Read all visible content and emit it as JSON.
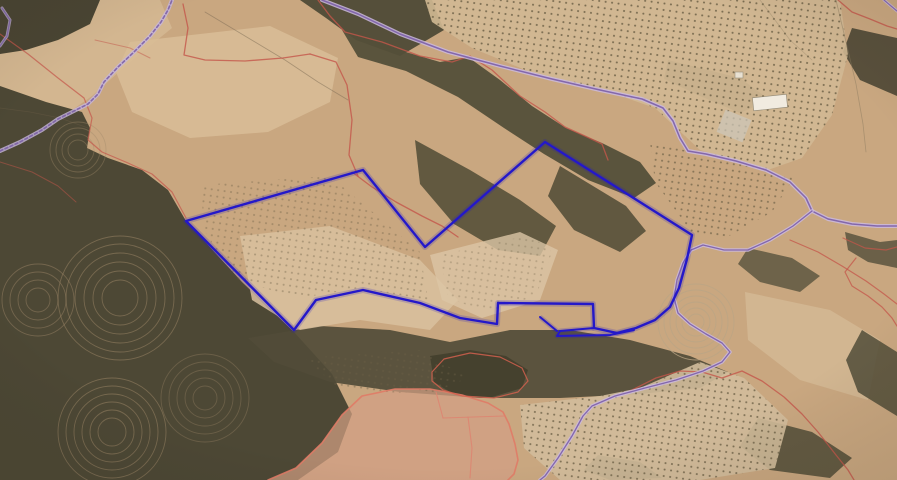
{
  "map": {
    "canvas": {
      "width": 897,
      "height": 480
    },
    "colors": {
      "selection_blue": "#2418c9",
      "road_purple": "#7e62aa",
      "road_casing": "#cbbade",
      "cadastral_red": "#c4564a",
      "parcel_pink_outline": "#e07b66",
      "terrain_base": "#c9a780",
      "scrub_dark": "#4d4835",
      "grove_dot": "#6b5f45"
    },
    "terrain": [
      {
        "name": "base-ground",
        "points": "0,0 897,0 897,480 0,480",
        "fill": "#c9a780",
        "opacity": 1
      },
      {
        "name": "snake-field",
        "points": "40,0 160,0 172,28 130,62 92,96 58,120 26,142 0,152 0,50 28,44",
        "fill": "#d4b690",
        "opacity": 0.95
      },
      {
        "name": "pale-top-center-field",
        "points": "130,42 270,26 338,58 330,102 268,132 190,138 132,112 116,72",
        "fill": "#d8bc96",
        "opacity": 0.9
      },
      {
        "name": "top-left-scrub",
        "points": "0,0 100,0 90,24 58,40 26,50 0,54",
        "fill": "#4a4533",
        "opacity": 1
      },
      {
        "name": "top-bridge-scrub",
        "points": "300,0 432,0 444,30 400,56 356,40 326,18",
        "fill": "#4f4a36",
        "opacity": 0.95
      },
      {
        "name": "left-forest",
        "points": "0,86 46,102 82,112 90,128 87,148 108,158 142,170 168,190 186,221 242,282 294,332 332,374 352,414 338,452 298,480 0,480",
        "fill": "#4d4835",
        "opacity": 1
      },
      {
        "name": "central-scrub-1",
        "points": "342,30 392,48 440,62 468,57 500,80 532,106 566,128 602,143 640,162 656,183 634,198 588,180 544,154 504,128 458,97 406,71 358,57",
        "fill": "#544f39",
        "opacity": 0.95
      },
      {
        "name": "central-scrub-2",
        "points": "415,140 470,170 520,200 556,226 540,256 498,250 454,224 420,184",
        "fill": "#565138",
        "opacity": 0.9
      },
      {
        "name": "central-scrub-3",
        "points": "560,166 626,206 646,231 620,252 574,230 548,196",
        "fill": "#4f4a35",
        "opacity": 0.85
      },
      {
        "name": "right-corner-forest",
        "points": "852,28 897,38 897,96 860,80 843,52",
        "fill": "#4c4734",
        "opacity": 0.9
      },
      {
        "name": "right-scrub-a",
        "points": "668,60 740,78 770,100 740,113 700,96 664,79",
        "fill": "#56513b",
        "opacity": 0.7
      },
      {
        "name": "mid-scrub-band",
        "points": "248,338 320,326 390,330 450,342 510,330 570,330 630,340 690,356 728,372 700,388 640,394 560,398 480,398 400,392 330,382 274,362",
        "fill": "#514c38",
        "opacity": 0.92
      },
      {
        "name": "dark-tree-cluster",
        "points": "430,356 470,350 506,356 528,370 522,388 492,397 455,395 434,382",
        "fill": "#45412e",
        "opacity": 1
      },
      {
        "name": "right-blob-b",
        "points": "748,248 792,258 820,276 800,292 760,282 738,264",
        "fill": "#57523c",
        "opacity": 0.8
      },
      {
        "name": "right-blob-c",
        "points": "845,232 880,242 897,240 897,268 868,262 848,250",
        "fill": "#544f3a",
        "opacity": 0.8
      },
      {
        "name": "pale-center-field",
        "points": "240,236 330,226 420,260 458,300 430,330 360,320 300,330 252,300",
        "fill": "#d9c19f",
        "opacity": 0.85
      },
      {
        "name": "pale-center-field-2",
        "points": "430,255 520,232 558,250 540,300 482,318 442,300",
        "fill": "#dcc5a5",
        "opacity": 0.8
      },
      {
        "name": "pale-right-slope",
        "points": "745,292 830,310 880,340 868,400 800,380 748,340",
        "fill": "#d6bc98",
        "opacity": 0.7
      },
      {
        "name": "right-blob-d",
        "points": "862,330 897,352 897,416 858,392 846,360",
        "fill": "#524d38",
        "opacity": 0.85
      },
      {
        "name": "right-blob-e",
        "points": "758,418 812,432 852,458 830,478 770,470 740,446",
        "fill": "#514c37",
        "opacity": 0.85
      },
      {
        "name": "small-scrub-br",
        "points": "598,455 640,462 662,478 610,480 584,470",
        "fill": "#524d38",
        "opacity": 0.8
      },
      {
        "name": "pink-parcel-fill",
        "points": "268,480 296,468 322,443 342,415 362,396 395,389 430,389 462,395 488,403 503,412 509,424 515,444 518,460 514,474 508,480",
        "fill": "#d2a083",
        "opacity": 0.72
      }
    ],
    "groves": [
      {
        "name": "grove-top-right",
        "points": "425,0 840,0 848,55 832,115 802,158 768,170 700,150 655,108 598,88 540,76 472,48 432,22",
        "base": "#d2b994",
        "dotOpacity": 0.85
      },
      {
        "name": "grove-right-small",
        "points": "650,142 795,176 772,212 722,240 692,233 655,182",
        "dotOpacity": 0.7
      },
      {
        "name": "grove-center-left",
        "points": "200,185 330,176 420,252 428,300 360,288 300,298 235,280 205,232",
        "dotOpacity": 0.4
      },
      {
        "name": "grove-bottom-right",
        "points": "520,405 600,396 640,388 700,362 744,378 788,420 775,468 700,480 560,480 524,448",
        "base": "#d2bc9b",
        "dotOpacity": 0.8
      },
      {
        "name": "grove-bottom-small",
        "points": "305,358 420,350 468,378 430,394 340,390",
        "dotOpacity": 0.45
      },
      {
        "name": "grove-center-sparse",
        "points": "440,255 530,235 552,252 536,296 486,312 448,298",
        "dotOpacity": 0.3
      }
    ],
    "contours": [
      {
        "name": "terrace-left-1",
        "cx": 120,
        "cy": 298,
        "radii": [
          18,
          27,
          36,
          45,
          54,
          62
        ],
        "stroke": "#a18a6a",
        "opacity": 0.5
      },
      {
        "name": "terrace-left-2",
        "cx": 112,
        "cy": 432,
        "radii": [
          14,
          22,
          30,
          38,
          46,
          54
        ],
        "stroke": "#a18a6a",
        "opacity": 0.5
      },
      {
        "name": "terrace-left-3",
        "cx": 38,
        "cy": 300,
        "radii": [
          12,
          20,
          28,
          36
        ],
        "stroke": "#a18a6a",
        "opacity": 0.45
      },
      {
        "name": "terrace-left-4",
        "cx": 205,
        "cy": 398,
        "radii": [
          12,
          20,
          28,
          36,
          44
        ],
        "stroke": "#a18a6a",
        "opacity": 0.35
      },
      {
        "name": "terrace-left-5",
        "cx": 78,
        "cy": 150,
        "radii": [
          10,
          16,
          22,
          28
        ],
        "stroke": "#a18a6a",
        "opacity": 0.4
      },
      {
        "name": "terrace-knoll-right",
        "cx": 696,
        "cy": 322,
        "radii": [
          8,
          14,
          20,
          26,
          32,
          38
        ],
        "stroke": "#baa584",
        "opacity": 0.8
      }
    ],
    "tracks": [
      {
        "name": "track-top-center",
        "points": "205,12 245,36 285,60 318,82 348,100",
        "color": "#7a6a52",
        "width": 0.8,
        "opacity": 0.5
      },
      {
        "name": "track-top-right-1",
        "points": "836,0 846,42 856,84 863,124 866,152",
        "color": "#8a7a5e",
        "width": 0.8,
        "opacity": 0.5
      },
      {
        "name": "track-top-right-2",
        "points": "760,0 790,40 812,60",
        "color": "#8a7a5e",
        "width": 0.8,
        "opacity": 0.35
      },
      {
        "name": "track-forest-edge",
        "points": "0,108 30,112 60,118 88,128",
        "color": "#6f6048",
        "width": 0.8,
        "opacity": 0.4
      }
    ],
    "cadastral": [
      {
        "name": "cadastral-topleft-1",
        "points": "183,4 188,28 184,55 205,60 245,61 283,58 310,54",
        "color": "#c4564a",
        "width": 1.3,
        "opacity": 0.8
      },
      {
        "name": "cadastral-topleft-2",
        "points": "310,54 336,62 347,85 352,120 349,155 358,176",
        "color": "#c4564a",
        "width": 1.3,
        "opacity": 0.8
      },
      {
        "name": "cadastral-central-top",
        "points": "318,0 330,16 345,32 382,42 420,56 452,62 470,56 492,70 520,96 545,112 565,127 585,136 602,144 608,160",
        "color": "#c4564a",
        "width": 1.3,
        "opacity": 0.8
      },
      {
        "name": "cadastral-central-bottom",
        "points": "352,172 372,187 396,202 422,216 442,226 458,237",
        "color": "#c4564a",
        "width": 1.3,
        "opacity": 0.8
      },
      {
        "name": "cadastral-forest-edge",
        "points": "0,34 28,54 58,78 84,98 92,118 88,140 102,152 128,163 152,174 172,192 186,218",
        "color": "#c4564a",
        "width": 1.2,
        "opacity": 0.7
      },
      {
        "name": "pink-parcel-outline",
        "points": "268,480 296,468 322,443 342,415 362,396 395,389 430,389 462,395 488,403 503,412 509,424 515,444 518,460 514,474 508,480",
        "color": "#e07b66",
        "width": 1.6,
        "opacity": 0.9
      },
      {
        "name": "pink-parcel-inner-1",
        "points": "436,392 443,418",
        "color": "#dd8571",
        "width": 1.1,
        "opacity": 0.9
      },
      {
        "name": "pink-parcel-inner-2",
        "points": "443,418 504,416",
        "color": "#dd8571",
        "width": 1.1,
        "opacity": 0.9
      },
      {
        "name": "pink-parcel-inner-3",
        "points": "468,417 472,448 470,478",
        "color": "#dd8571",
        "width": 1.1,
        "opacity": 0.9
      },
      {
        "name": "cadastral-cluster-ring",
        "points": "432,372 444,359 470,353 500,357 522,368 528,381 518,392 494,398 462,396 443,390 432,381",
        "color": "#d2604e",
        "width": 1.2,
        "opacity": 0.85,
        "closed": true
      },
      {
        "name": "cadastral-bottom-right",
        "points": "630,391 656,378 680,371 702,372 722,378 742,371 762,381 784,397 802,414 818,432 836,455 848,470 854,480",
        "color": "#c4564a",
        "width": 1.3,
        "opacity": 0.8
      },
      {
        "name": "cadastral-right-diag",
        "points": "790,240 818,252 842,266 866,281 884,294 897,304",
        "color": "#c4564a",
        "width": 1.2,
        "opacity": 0.75
      },
      {
        "name": "cadastral-right-1",
        "points": "843,238 865,248 886,250 897,247",
        "color": "#c4564a",
        "width": 1.2,
        "opacity": 0.75
      },
      {
        "name": "cadastral-right-2",
        "points": "856,258 845,272 852,286 868,296 882,307 892,318 897,326",
        "color": "#c4564a",
        "width": 1.2,
        "opacity": 0.75
      },
      {
        "name": "cadastral-top-right-corner",
        "points": "838,0 852,12 870,19 887,26 897,29",
        "color": "#c4564a",
        "width": 1.3,
        "opacity": 0.8
      },
      {
        "name": "cadastral-left-low",
        "points": "0,162 32,172 58,186 76,202",
        "color": "#c4564a",
        "width": 1,
        "opacity": 0.5
      },
      {
        "name": "cadastral-left-small",
        "points": "95,40 130,48 150,58",
        "color": "#c4564a",
        "width": 1,
        "opacity": 0.5
      }
    ],
    "roads": [
      {
        "name": "road-snake-topleft",
        "points": "0,151 20,142 42,130 58,119 72,112 88,104 98,94 104,82 118,67 134,52 150,36 161,22 168,10 172,0",
        "caseColor": "#c7b6dc",
        "caseWidth": 4,
        "caseOpacity": 0.8,
        "lineColor": "#7b5fa6",
        "lineWidth": 1.6,
        "lineOpacity": 0.9,
        "dash": "3 2.5"
      },
      {
        "name": "road-main-diagonal",
        "points": "322,0 358,14 400,34 448,52 500,66 552,79 600,90 642,99 663,108 673,121 680,138 688,151 706,154 736,161 766,170 790,182 806,198 812,211 828,219 852,224 877,226 897,226",
        "caseColor": "#cbbade",
        "caseWidth": 4,
        "caseOpacity": 0.85,
        "lineColor": "#7e62aa",
        "lineWidth": 1.5,
        "lineOpacity": 0.95
      },
      {
        "name": "road-branch-south",
        "points": "812,211 793,226 770,240 748,250 724,250 703,245 691,250 683,263 677,280 674,298 678,313 690,324 706,334 722,343 730,352 722,362 703,371 676,380 645,388 615,396 592,406 583,416 572,436 558,458 545,476 540,480",
        "caseColor": "#cbbade",
        "caseWidth": 3.5,
        "caseOpacity": 0.85,
        "lineColor": "#7e62aa",
        "lineWidth": 1.3,
        "lineOpacity": 0.95
      },
      {
        "name": "road-top-right-corner",
        "points": "884,0 891,6 897,11",
        "caseColor": "#cbbade",
        "caseWidth": 3,
        "caseOpacity": 0.8,
        "lineColor": "#7e62aa",
        "lineWidth": 1.2,
        "lineOpacity": 0.9
      },
      {
        "name": "road-left-edge-top",
        "points": "2,8 10,20 7,36 0,46",
        "caseColor": "#c7b6dc",
        "caseWidth": 3,
        "caseOpacity": 0.7,
        "lineColor": "#7b5fa6",
        "lineWidth": 1.3,
        "lineOpacity": 0.8
      }
    ],
    "buildings": [
      {
        "name": "farm-building-main",
        "x": 753,
        "y": 96,
        "w": 34,
        "h": 13,
        "rot": -6,
        "fill": "#f1ebe0",
        "stroke": "#938a77",
        "opacity": 1
      },
      {
        "name": "farm-building-small",
        "x": 735,
        "y": 72,
        "w": 8,
        "h": 6,
        "rot": 0,
        "fill": "#ece6da",
        "stroke": "#938a77",
        "opacity": 0.9
      },
      {
        "name": "light-ground-patch",
        "x": 720,
        "y": 114,
        "w": 28,
        "h": 24,
        "rot": 22,
        "fill": "#ccc5b7",
        "stroke": "none",
        "opacity": 0.75
      }
    ],
    "selected_parcel": {
      "name": "selected-parcel-outline",
      "color": "#2418c9",
      "halo_opacity": 0.2,
      "width": 2.4,
      "ring": "186,221 363,170 425,247 545,142 692,235 687,259 679,288 670,307 655,320 636,328 617,333 594,328 593,304 498,303 497,324 460,318 420,303 363,290 316,300 294,330",
      "extras": [
        {
          "name": "selected-parcel-sliver",
          "points": "594,328 560,331 557,336 610,335 634,330"
        },
        {
          "name": "selected-parcel-stub",
          "points": "540,317 557,331"
        }
      ]
    }
  }
}
